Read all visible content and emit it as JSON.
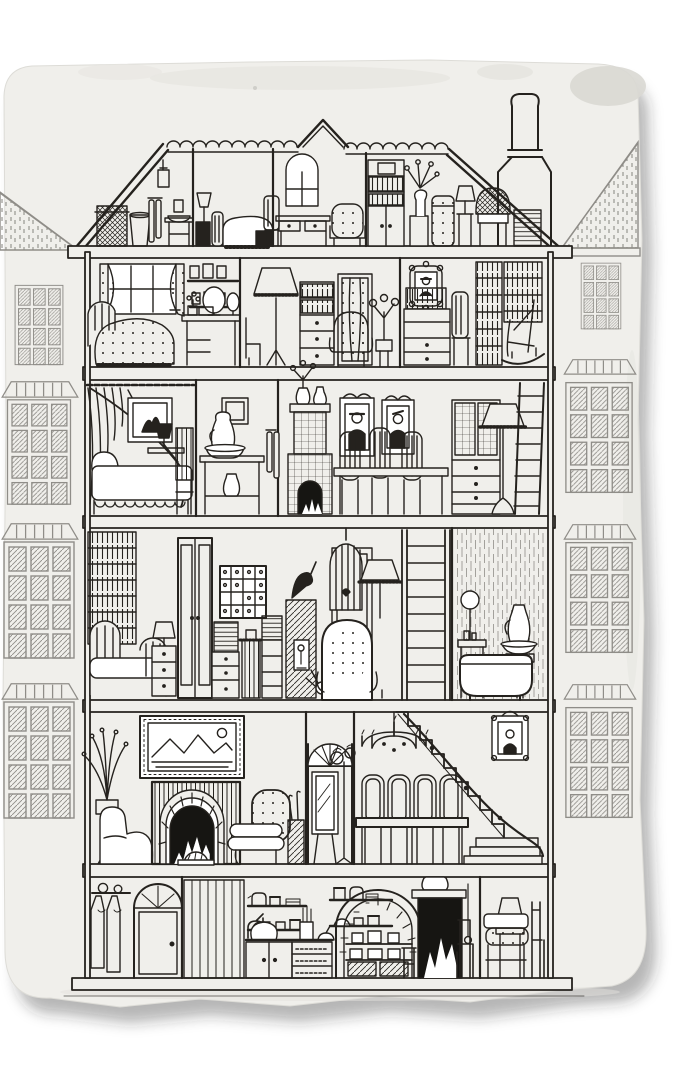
{
  "palette": {
    "background": "#ffffff",
    "paper": "#f0efeb",
    "stain": "#e3e2dd",
    "stain_dark": "#d9d8d3",
    "ink": "#25221e",
    "neighbor_ink": "#8f8d88",
    "fire_black": "#161512",
    "shadow": "rgba(40,40,40,0.34)"
  },
  "paper": {
    "type": "sketchbook-page",
    "edges": "rounded top corners, torn right and bottom edges with drop shadow",
    "stains": [
      "faint band along top",
      "dark blotch top-right",
      "grime along bottom edge"
    ]
  },
  "illustration": {
    "subject": "dollhouse-cross-section",
    "style": "pen-and-ink line drawing on paper",
    "house": {
      "roof": {
        "items": [
          "scalloped ridge tiles",
          "central gable peak",
          "tall chimney with pot"
        ]
      },
      "floors": [
        {
          "id": "attic",
          "rooms": [
            {
              "name": "wash-corner",
              "items": [
                "wicker hamper",
                "bucket",
                "hanging towels",
                "hanging oil lamp",
                "washstand with bowl and jug"
              ]
            },
            {
              "name": "maid-bedroom",
              "items": [
                "lamp on black nightstand",
                "single bed with fringed coverlet",
                "black trunk"
              ]
            },
            {
              "name": "window-study",
              "items": [
                "arched window",
                "tall-back chair",
                "writing desk with drawers",
                "dotted armchair"
              ]
            },
            {
              "name": "open-attic",
              "items": [
                "cupboard with bookshelf and box",
                "pedestal with vase of flowers",
                "dotted drum jar",
                "lamp on narrow stand",
                "wicker round-back chair",
                "stack of linens",
                "chimney breast"
              ]
            }
          ]
        },
        {
          "id": "second-floor",
          "rooms": [
            {
              "name": "bedroom",
              "items": [
                "window with floral curtains",
                "bed with dotted coverlet and fringe",
                "two picture shelves",
                "dressing table with round mirror, posy and box"
              ]
            },
            {
              "name": "sitting-room",
              "items": [
                "side chair",
                "fringed floor lamp",
                "bookcase chest of drawers",
                "door with star curtain",
                "dotted armchair",
                "flower stand"
              ]
            },
            {
              "name": "study",
              "items": [
                "scallop-framed portrait",
                "bureau with books on top",
                "tall chair",
                "two full bookcases",
                "rocking chair"
              ]
            }
          ]
        },
        {
          "id": "third-floor",
          "rooms": [
            {
              "name": "bedroom",
              "items": [
                "swagged window curtain",
                "framed picture",
                "black lamp on side table",
                "day bed with scalloped skirt",
                "striped high-back chair"
              ]
            },
            {
              "name": "wash-alcove",
              "items": [
                "small wall frame",
                "washstand table with jug and basin",
                "white pitcher",
                "hanging towels"
              ]
            },
            {
              "name": "dining-room",
              "items": [
                "tiled stove with fire",
                "vase of flowers and jug on mantel",
                "two framed portraits",
                "three high-back chairs",
                "dining table",
                "glass-front dresser with drawers",
                "fringed floor lamp",
                "wall ladder"
              ]
            }
          ]
        },
        {
          "id": "fourth-floor",
          "rooms": [
            {
              "name": "bedroom",
              "items": [
                "tall bookcase",
                "iron bed",
                "nightstand with lamp",
                "tall double doors"
              ]
            },
            {
              "name": "studio",
              "items": [
                "framed print grid",
                "stacked books on chests",
                "fringed black vase",
                "hatched plinth with bird sculpture",
                "figurine niche",
                "spiky plant head",
                "hanging birdcage with bird",
                "button-tufted wing chair",
                "fringed floor lamp"
              ]
            },
            {
              "name": "ladder-shaft",
              "items": [
                "wide rung ladder"
              ]
            },
            {
              "name": "bathroom",
              "items": [
                "planked wall",
                "round mirror washstand",
                "bathtub",
                "pedestal with jug and basin"
              ]
            }
          ]
        },
        {
          "id": "first-floor",
          "rooms": [
            {
              "name": "parlour",
              "items": [
                "potted plant on stand",
                "armchair",
                "framed landscape painting",
                "striped fireplace with arched hearth and blazing fire",
                "fan fire screen",
                "button-tufted chair with rolled cushions",
                "umbrella stand"
              ]
            },
            {
              "name": "entrance-hall",
              "items": [
                "fanlight arch over door",
                "cheval mirror",
                "flower hat stand"
              ]
            },
            {
              "name": "dining-room",
              "items": [
                "candle chandelier",
                "four high-back chairs",
                "dining table",
                "winding staircase with handrail",
                "crowned portrait frame"
              ]
            }
          ]
        },
        {
          "id": "basement-kitchen",
          "rooms": [
            {
              "name": "hallway",
              "items": [
                "coat rack with coats and hats",
                "arched front door with fan"
              ]
            },
            {
              "name": "stair-panel",
              "items": [
                "vertical plank panelling"
              ]
            },
            {
              "name": "kitchen",
              "items": [
                "water pump",
                "two crockery shelves",
                "lidded pot",
                "utensil jar",
                "mortar bowl",
                "dresser cupboards and filled drawers",
                "brick range arch with shelved pots",
                "log boxes",
                "stool",
                "black cooking stove with fire",
                "warming urn",
                "chain pull",
                "side chair"
              ]
            },
            {
              "name": "snug",
              "items": [
                "table lamp",
                "settle with dotted cushion",
                "side chair"
              ]
            }
          ]
        }
      ]
    },
    "neighbors": {
      "left": {
        "items": [
          "hatched roof slope",
          "four leaded lattice windows with fanned lintels"
        ]
      },
      "right": {
        "items": [
          "hatched roof slope",
          "four leaded lattice windows with fanned lintels"
        ]
      }
    }
  }
}
